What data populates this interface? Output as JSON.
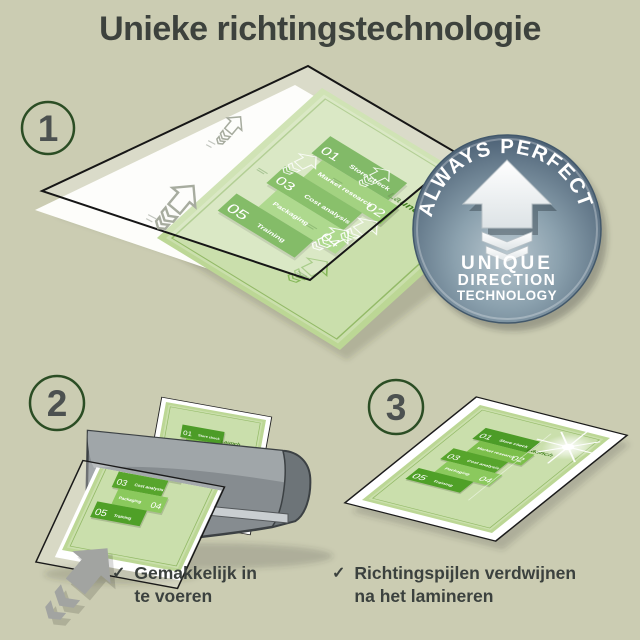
{
  "title": "Unieke richtingstechnologie",
  "steps": {
    "one": "1",
    "two": "2",
    "three": "3"
  },
  "badge": {
    "arc_text": "ALWAYS PERFECT!",
    "line1": "UNIQUE",
    "line2": "DIRECTION",
    "line3": "TECHNOLOGY"
  },
  "doc": {
    "n1": "01",
    "t1": "Store check",
    "t2": "Market research",
    "n2": "02",
    "n3": "03",
    "t3": "Cost analysis",
    "t4": "Packaging",
    "n4": "04",
    "n5": "05",
    "t5": "Training",
    "launch": "Launch"
  },
  "captions": {
    "check": "✓",
    "c1_line1": "Gemakkelijk in",
    "c1_line2": "te voeren",
    "c2_line1": "Richtingspijlen verdwijnen",
    "c2_line2": "na het lamineren"
  },
  "colors": {
    "background": "#cbccb2",
    "title_text": "#3d423d",
    "step_circle_green": "#2b4d24",
    "doc_green_dark": "#4c9c27",
    "doc_green_body": "#bcd795",
    "badge_steel": "#7b94a4",
    "machine_gray": "#868c90"
  }
}
